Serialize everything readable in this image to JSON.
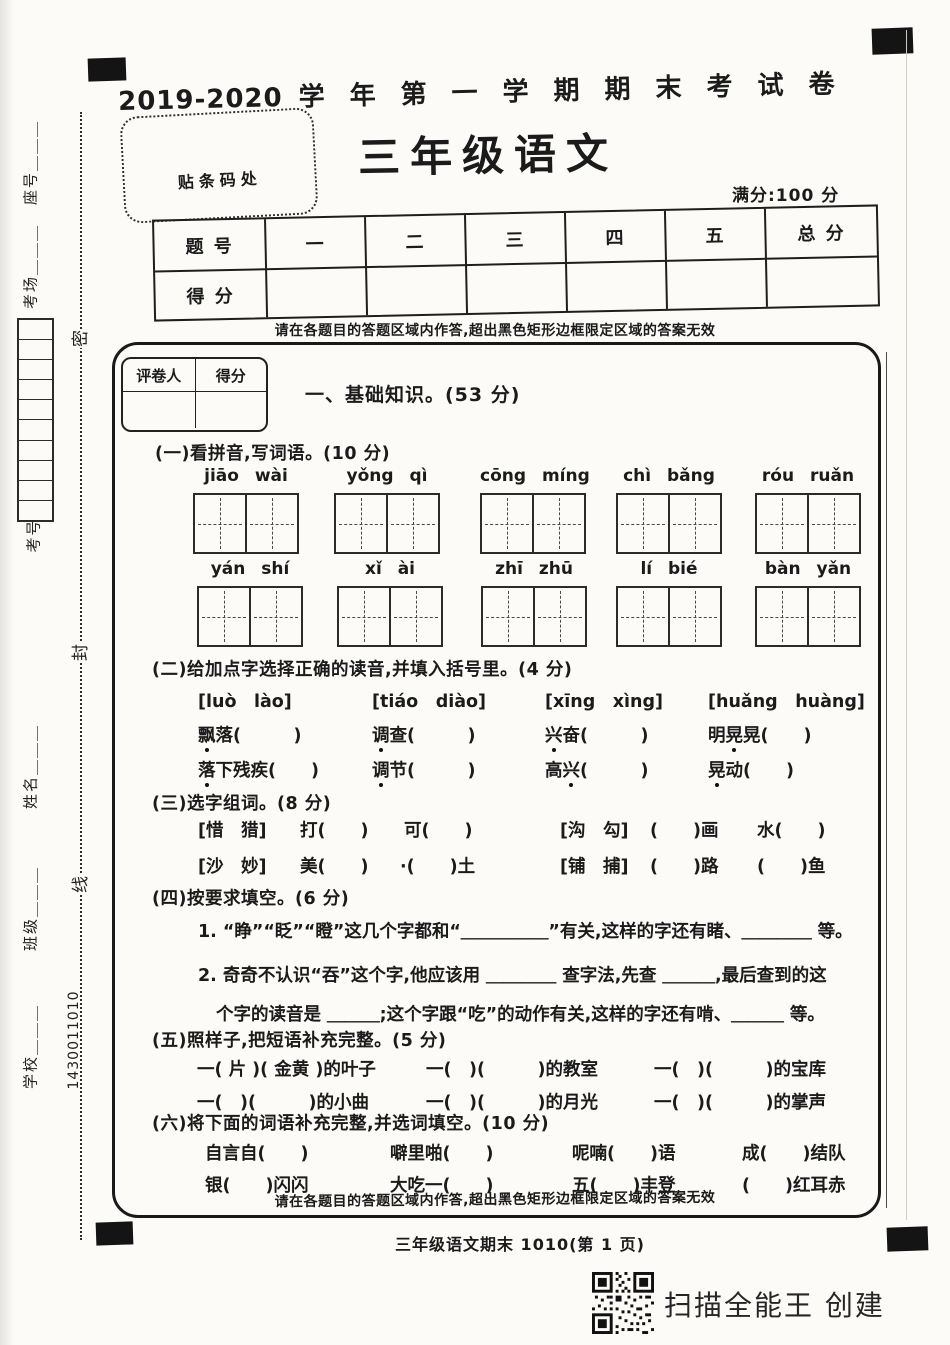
{
  "header": {
    "year": "2019-2020",
    "term_title": "学年第一学期期末考试卷",
    "barcode_label": "贴条码处",
    "paper_title": "三年级语文",
    "full_score": "满分:100 分"
  },
  "margin": {
    "seat": "座号＿＿＿",
    "room": "考场＿＿＿",
    "exam_no": "考号",
    "name": "姓名＿＿＿",
    "clazz": "班级＿＿＿",
    "school": "学校＿＿＿",
    "code": "1430011010",
    "seal_1": "密",
    "seal_2": "封",
    "seal_3": "线"
  },
  "score_table": {
    "c0": "题 号",
    "c1": "一",
    "c2": "二",
    "c3": "三",
    "c4": "四",
    "c5": "五",
    "c6": "总 分",
    "row_label": "得 分"
  },
  "notice": {
    "top": "请在各题目的答题区域内作答,超出黑色矩形边框限定区域的答案无效",
    "bottom": "请在各题目的答题区域内作答,超出黑色矩形边框限定区域的答案无效"
  },
  "grader": {
    "col1": "评卷人",
    "col2": "得分"
  },
  "part1": {
    "title": "一、基础知识。(53 分)"
  },
  "s1": {
    "title": "(一)看拼音,写词语。(10 分)",
    "row1": [
      "jiāo wài",
      "yǒng qì",
      "cōng míng",
      "chì bǎng",
      "róu ruǎn"
    ],
    "row2": [
      "yán shí",
      "xǐ ài",
      "zhī zhū",
      "lí bié",
      "bàn yǎn"
    ]
  },
  "s2": {
    "title": "(二)给加点字选择正确的读音,并填入括号里。(4 分)",
    "g": [
      {
        "opt": "[luò　lào]",
        "a_pre": "",
        "a_dot": "飘",
        "a_post": "落(　　　)",
        "b_pre": "",
        "b_dot": "落",
        "b_post": "下残疾(　　)"
      },
      {
        "opt": "[tiáo　diào]",
        "a_pre": "",
        "a_dot": "调",
        "a_post": "查(　　　)",
        "b_pre": "",
        "b_dot": "调",
        "b_post": "节(　　　)"
      },
      {
        "opt": "[xīng　xìng]",
        "a_pre": "",
        "a_dot": "兴",
        "a_post": "奋(　　　)",
        "b_pre": "高",
        "b_dot": "兴",
        "b_post": "(　　　)"
      },
      {
        "opt": "[huǎng　huàng]",
        "a_pre": "明",
        "a_dot": "晃",
        "a_post": "晃(　　)",
        "b_pre": "",
        "b_dot": "晃",
        "b_post": "动(　　)"
      }
    ]
  },
  "s3": {
    "title": "(三)选字组词。(8 分)",
    "r1": [
      "[惜　猎]",
      "打(　　)",
      "可(　　)",
      "[沟　勾]",
      "(　　)画",
      "水(　　)"
    ],
    "r2": [
      "[沙　妙]",
      "美(　　)",
      "·(　　)土",
      "[铺　捕]",
      "(　　)路",
      "(　　)鱼"
    ]
  },
  "s4": {
    "title": "(四)按要求填空。(6 分)",
    "l1": "1. “睁”“眨”“瞪”这几个字都和“＿＿＿＿＿”有关,这样的字还有睹、＿＿＿＿ 等。",
    "l2": "2. 奇奇不认识“吞”这个字,他应该用 ＿＿＿＿ 查字法,先查 ＿＿＿,最后查到的这",
    "l3": "个字的读音是 ＿＿＿;这个字跟“吃”的动作有关,这样的字还有啃、＿＿＿ 等。"
  },
  "s5": {
    "title": "(五)照样子,把短语补充完整。(5 分)",
    "r1": [
      "一( 片 )( 金黄 )的叶子",
      "一(　)(　　　)的教室",
      "一(　)(　　　)的宝库"
    ],
    "r2": [
      "一(　)(　　　)的小曲",
      "一(　)(　　　)的月光",
      "一(　)(　　　)的掌声"
    ]
  },
  "s6": {
    "title": "(六)将下面的词语补充完整,并选词填空。(10 分)",
    "r1": [
      "自言自(　　)",
      "噼里啪(　　)",
      "呢喃(　　)语",
      "成(　　)结队"
    ],
    "r2": [
      "银(　　)闪闪",
      "大吃一(　　)",
      "五(　　)丰登",
      "(　　)红耳赤"
    ]
  },
  "footer": {
    "page_label": "三年级语文期末 1010(第 1 页)",
    "scanner": "扫描全能王 创建"
  }
}
